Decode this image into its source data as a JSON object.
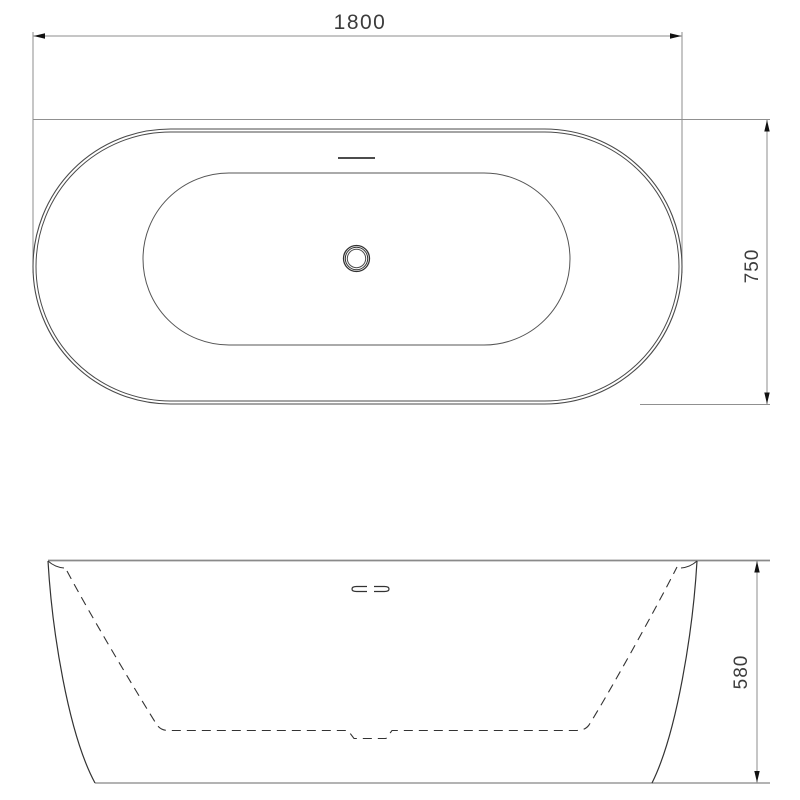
{
  "drawing": {
    "type": "bathtub-technical-drawing",
    "views": {
      "top": {
        "dimensions": {
          "width": {
            "value": "1800"
          },
          "depth": {
            "value": "750"
          }
        },
        "features": [
          "rim-outline",
          "basin-outline",
          "overflow-mark",
          "drain"
        ]
      },
      "front": {
        "dimensions": {
          "height": {
            "value": "580"
          }
        },
        "features": [
          "outer-profile",
          "hidden-interior-line",
          "overflow-slots",
          "drain-recess"
        ]
      }
    },
    "colors": {
      "background": "#ffffff",
      "object_line": "#3f3f3f",
      "thin_line": "#606060",
      "dimension_line": "#8c8c8c",
      "arrowhead": "#111111"
    }
  }
}
